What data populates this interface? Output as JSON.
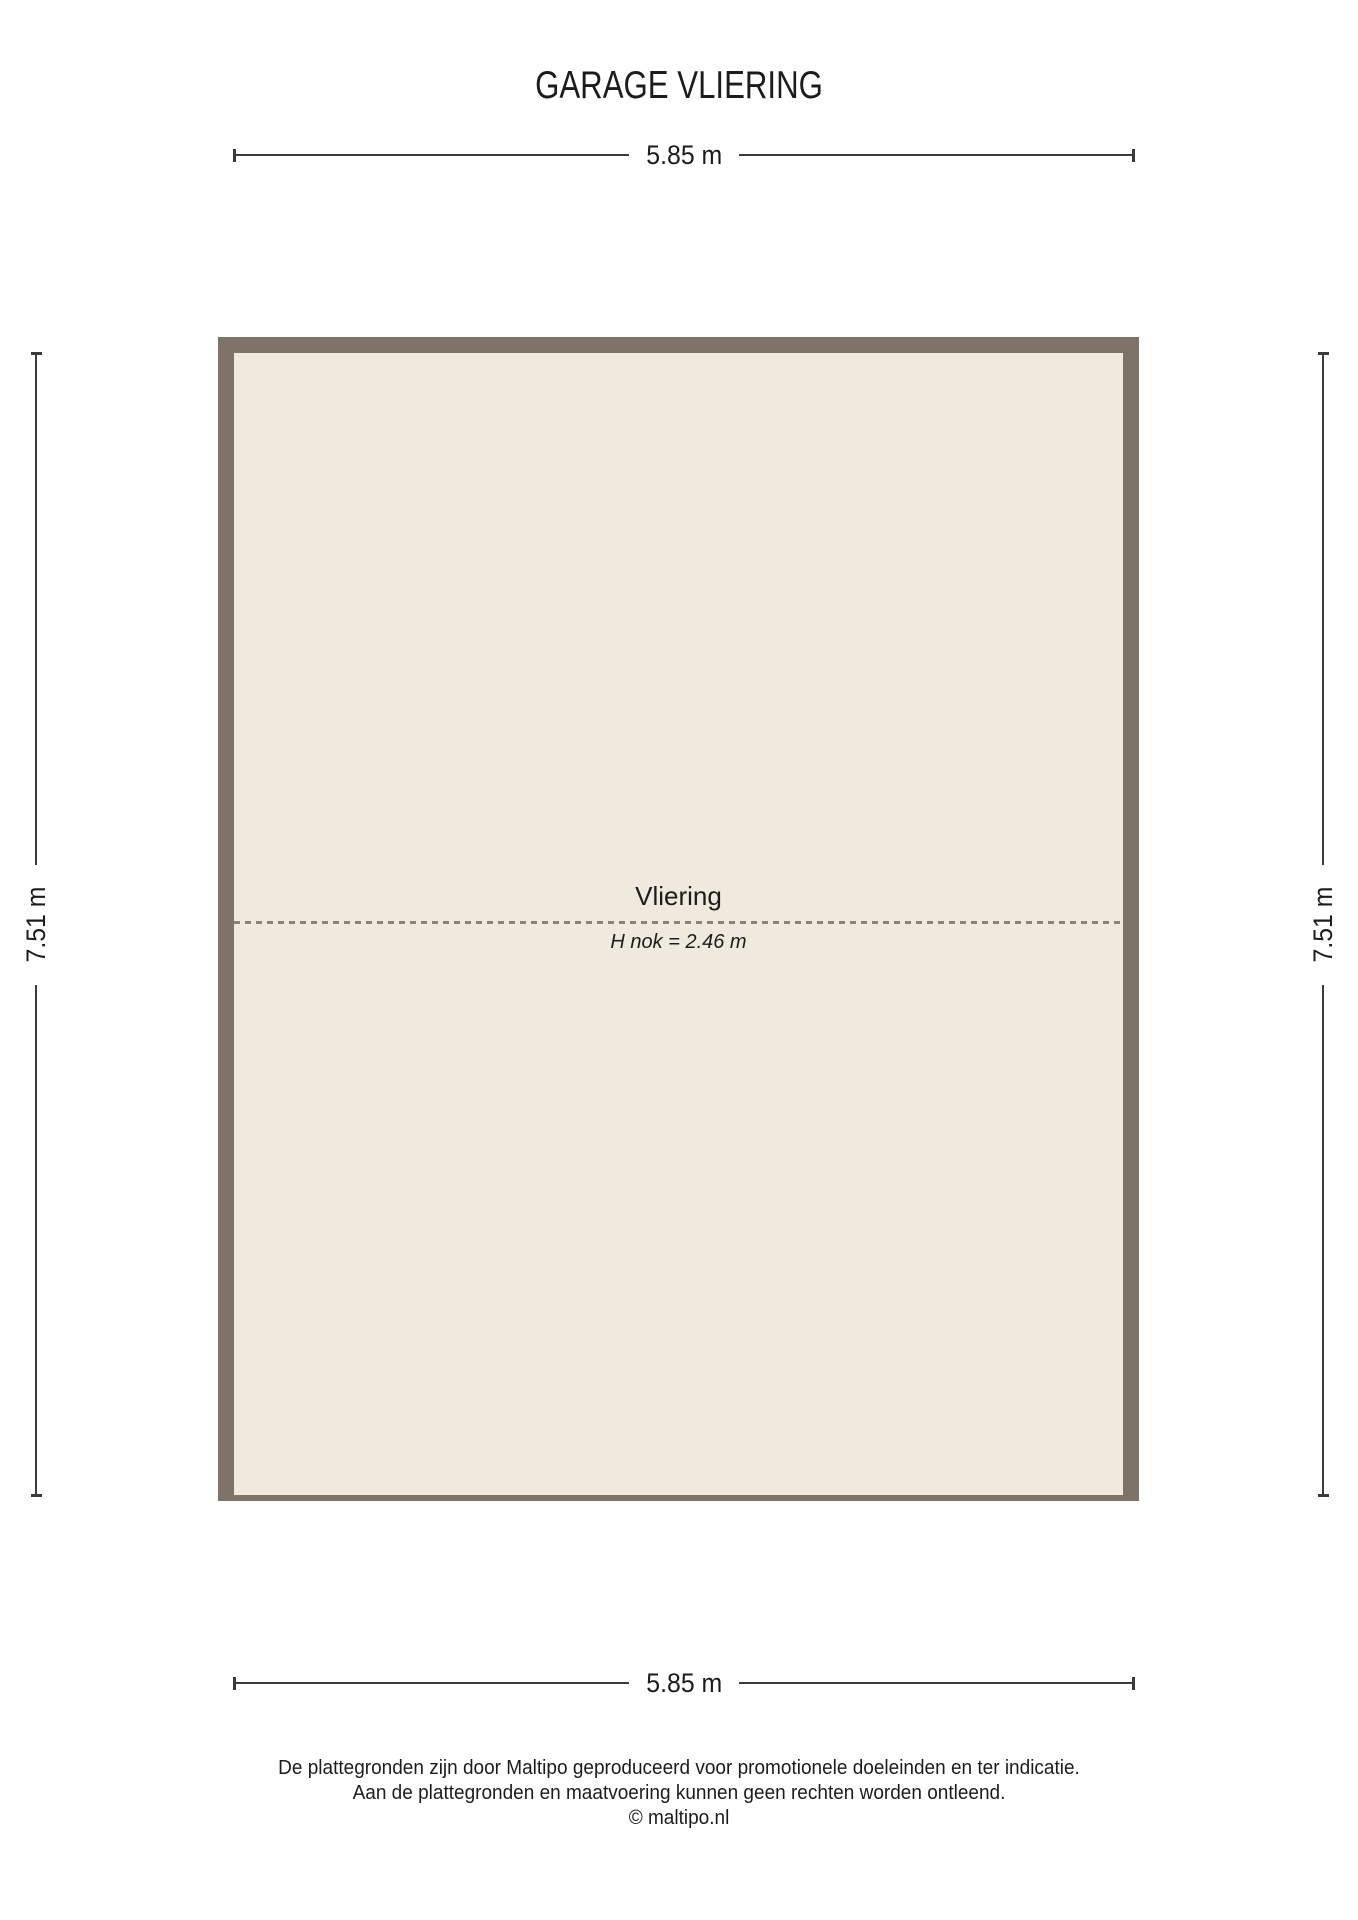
{
  "title": "GARAGE VLIERING",
  "dimensions": {
    "top": "5.85 m",
    "bottom": "5.85 m",
    "left": "7.51 m",
    "right": "7.51 m"
  },
  "room": {
    "name": "Vliering",
    "ridge_height": "H nok = 2.46 m"
  },
  "colors": {
    "wall": "#7e7368",
    "floor": "#f0e9de",
    "ridge_dash": "#8d8277",
    "dimension_line": "#3b3b3a",
    "text": "#1c1c1b",
    "background": "#ffffff"
  },
  "footer": {
    "line1": "De plattegronden zijn door Maltipo geproduceerd voor promotionele doeleinden en ter indicatie.",
    "line2": "Aan de plattegronden en maatvoering kunnen geen rechten worden ontleend.",
    "line3": "© maltipo.nl"
  }
}
